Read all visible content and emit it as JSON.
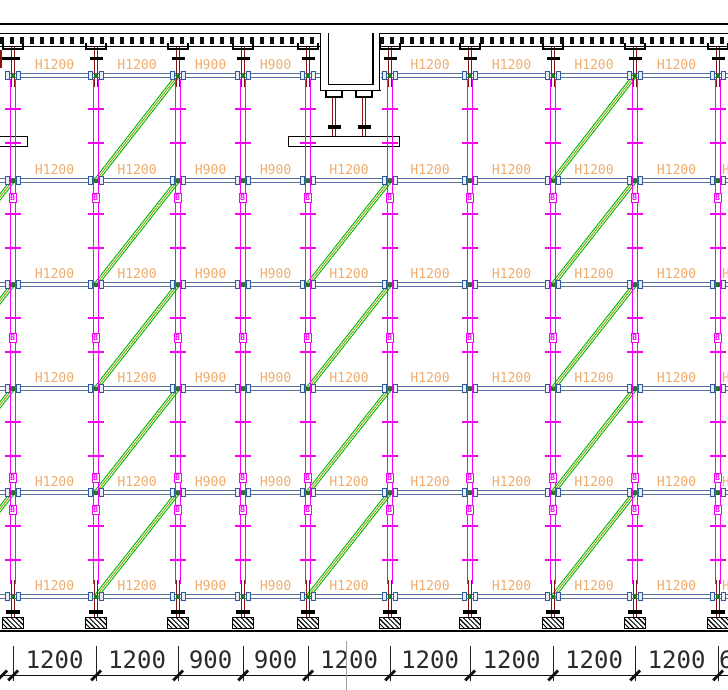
{
  "drawing": {
    "title": "scaffold-formwork-elevation",
    "canvas": {
      "width": 728,
      "height": 690,
      "background": "#ffffff"
    },
    "colors": {
      "post_magenta": "#f700f7",
      "jack_maroon": "#8a1414",
      "ledger_blue": "#54719f",
      "node_border": "#30599a",
      "node_fill": "#e8eef7",
      "node_dot": "#217a21",
      "brace_green": "#00b800",
      "brace_core": "#8f9b00",
      "label_orange": "#f0ad6e",
      "dim_text": "#2b2b2b",
      "line_black": "#000000",
      "cursor_gray": "#9ba39b"
    },
    "posts_x": [
      13,
      96,
      178,
      243,
      308,
      390,
      470,
      553,
      635,
      718
    ],
    "levels_y": [
      73,
      178,
      282,
      386,
      490,
      594
    ],
    "post": {
      "magenta_top": 79,
      "magenta_bottom": 584,
      "tick_offsets": [
        35,
        69
      ],
      "sleeve_offsets": [
        null,
        15,
        51,
        87,
        15
      ],
      "sleeve_letter": "B"
    },
    "top_jack": {
      "y1": 47,
      "y2": 87,
      "u_head_y": 48,
      "collar_y": 56.5
    },
    "bottom_jack": {
      "y1": 580,
      "y2": 618,
      "collar_y": 610,
      "plate_y": 617,
      "plate_w": 22,
      "plate_h": 12
    },
    "ground_y": 630,
    "slab": {
      "top_line_y": 23,
      "band_y": 33,
      "band_h": 14,
      "band_segments": [
        [
          0,
          320
        ],
        [
          380,
          728
        ]
      ]
    },
    "beam": {
      "outer_x1": 319.5,
      "outer_x2": 380.5,
      "inner_x1": 327.5,
      "inner_x2": 372.3,
      "top_y": 33,
      "outer_bottom_y": 89.5,
      "inner_bottom_y": 84,
      "jacks_x": [
        334,
        364
      ],
      "jack_top_y": 92,
      "jack_collar_y": 125
    },
    "boards": [
      {
        "x": -6,
        "y": 136,
        "w": 34,
        "h": 11
      },
      {
        "x": 288,
        "y": 136,
        "w": 112,
        "h": 11
      }
    ],
    "bays": [
      {
        "label": "H1200",
        "dim": "1200"
      },
      {
        "label": "H1200",
        "dim": "1200"
      },
      {
        "label": "H900",
        "dim": "900"
      },
      {
        "label": "H900",
        "dim": "900"
      },
      {
        "label": "H1200",
        "dim": "1200"
      },
      {
        "label": "H1200",
        "dim": "1200"
      },
      {
        "label": "H1200",
        "dim": "1200"
      },
      {
        "label": "H1200",
        "dim": "1200"
      },
      {
        "label": "H1200",
        "dim": "1200"
      }
    ],
    "row1_beam_bay_index": 4,
    "partial_right_bay": {
      "label": "H600",
      "dim": "600",
      "x": 719,
      "label_rows": [
        1,
        2,
        3,
        4,
        5
      ]
    },
    "braces": [
      {
        "x1": -69,
        "x2": 13,
        "top_levels": [
          1,
          2,
          3,
          4
        ]
      },
      {
        "x1": 96,
        "x2": 178,
        "top_levels": [
          0,
          1,
          2,
          3,
          4
        ]
      },
      {
        "x1": 308,
        "x2": 390,
        "top_levels": [
          1,
          2,
          3,
          4
        ]
      },
      {
        "x1": 553,
        "x2": 635,
        "top_levels": [
          0,
          1,
          2,
          3,
          4
        ]
      }
    ],
    "dims": {
      "line_y": 675,
      "ext_y1": 646,
      "ext_y2": 681,
      "text_top": 648,
      "left_edge_tick_x": 2
    },
    "cursor_line": {
      "x": 346,
      "y1": 641,
      "y2": 690
    },
    "fragments": {
      "top_left_collar": {
        "x": 0,
        "y": 56.5,
        "w": 7,
        "h": 3.5
      },
      "top_left_jack": {
        "x": 0,
        "y": 50,
        "w": 2,
        "h": 18
      }
    }
  }
}
